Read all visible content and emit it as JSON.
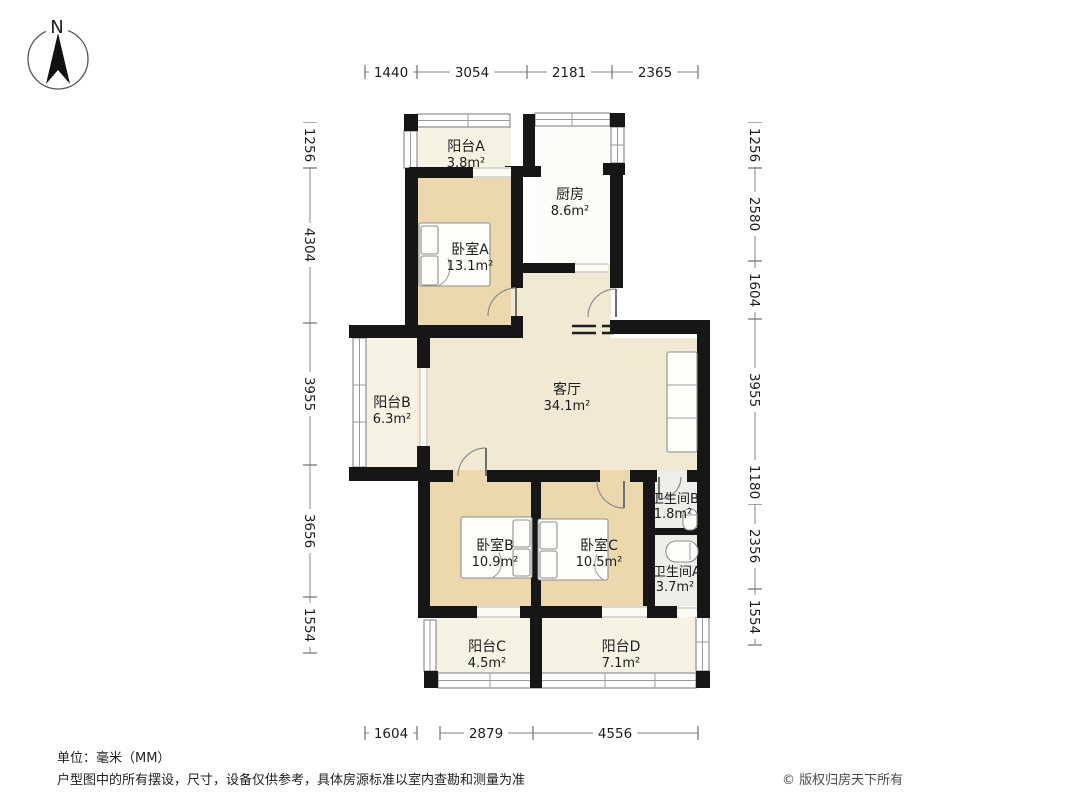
{
  "compass": {
    "label": "N"
  },
  "dimensions": {
    "unit": "mm",
    "top": [
      "1440",
      "3054",
      "2181",
      "2365"
    ],
    "bottom": [
      "1604",
      "2879",
      "4556"
    ],
    "left": [
      "1256",
      "4304",
      "3955",
      "3656",
      "1554"
    ],
    "right": [
      "1256",
      "2580",
      "1604",
      "3955",
      "1180",
      "2356",
      "1554"
    ]
  },
  "rooms": {
    "balcony_a": {
      "name": "阳台A",
      "area": "3.8m²"
    },
    "kitchen": {
      "name": "厨房",
      "area": "8.6m²"
    },
    "bedroom_a": {
      "name": "卧室A",
      "area": "13.1m²"
    },
    "balcony_b": {
      "name": "阳台B",
      "area": "6.3m²"
    },
    "living": {
      "name": "客厅",
      "area": "34.1m²"
    },
    "bedroom_b": {
      "name": "卧室B",
      "area": "10.9m²"
    },
    "bedroom_c": {
      "name": "卧室C",
      "area": "10.5m²"
    },
    "bath_b": {
      "name": "卫生间B",
      "area": "1.8m²"
    },
    "bath_a": {
      "name": "卫生间A",
      "area": "3.7m²"
    },
    "balcony_c": {
      "name": "阳台C",
      "area": "4.5m²"
    },
    "balcony_d": {
      "name": "阳台D",
      "area": "7.1m²"
    }
  },
  "footer": {
    "unit_note": "单位：毫米（MM）",
    "disclaimer": "户型图中的所有摆设，尺寸，设备仅供参考，具体房源标准以室内查勘和测量为准",
    "copyright": "© 版权归房天下所有"
  },
  "colors": {
    "wall": "#161616",
    "bedroom_fill": "#ecd8ad",
    "living_fill": "#f2e9d4",
    "balcony_fill": "#f7f3e3",
    "bath_fill": "#ededea",
    "kitchen_fill": "#fcfcf8"
  }
}
